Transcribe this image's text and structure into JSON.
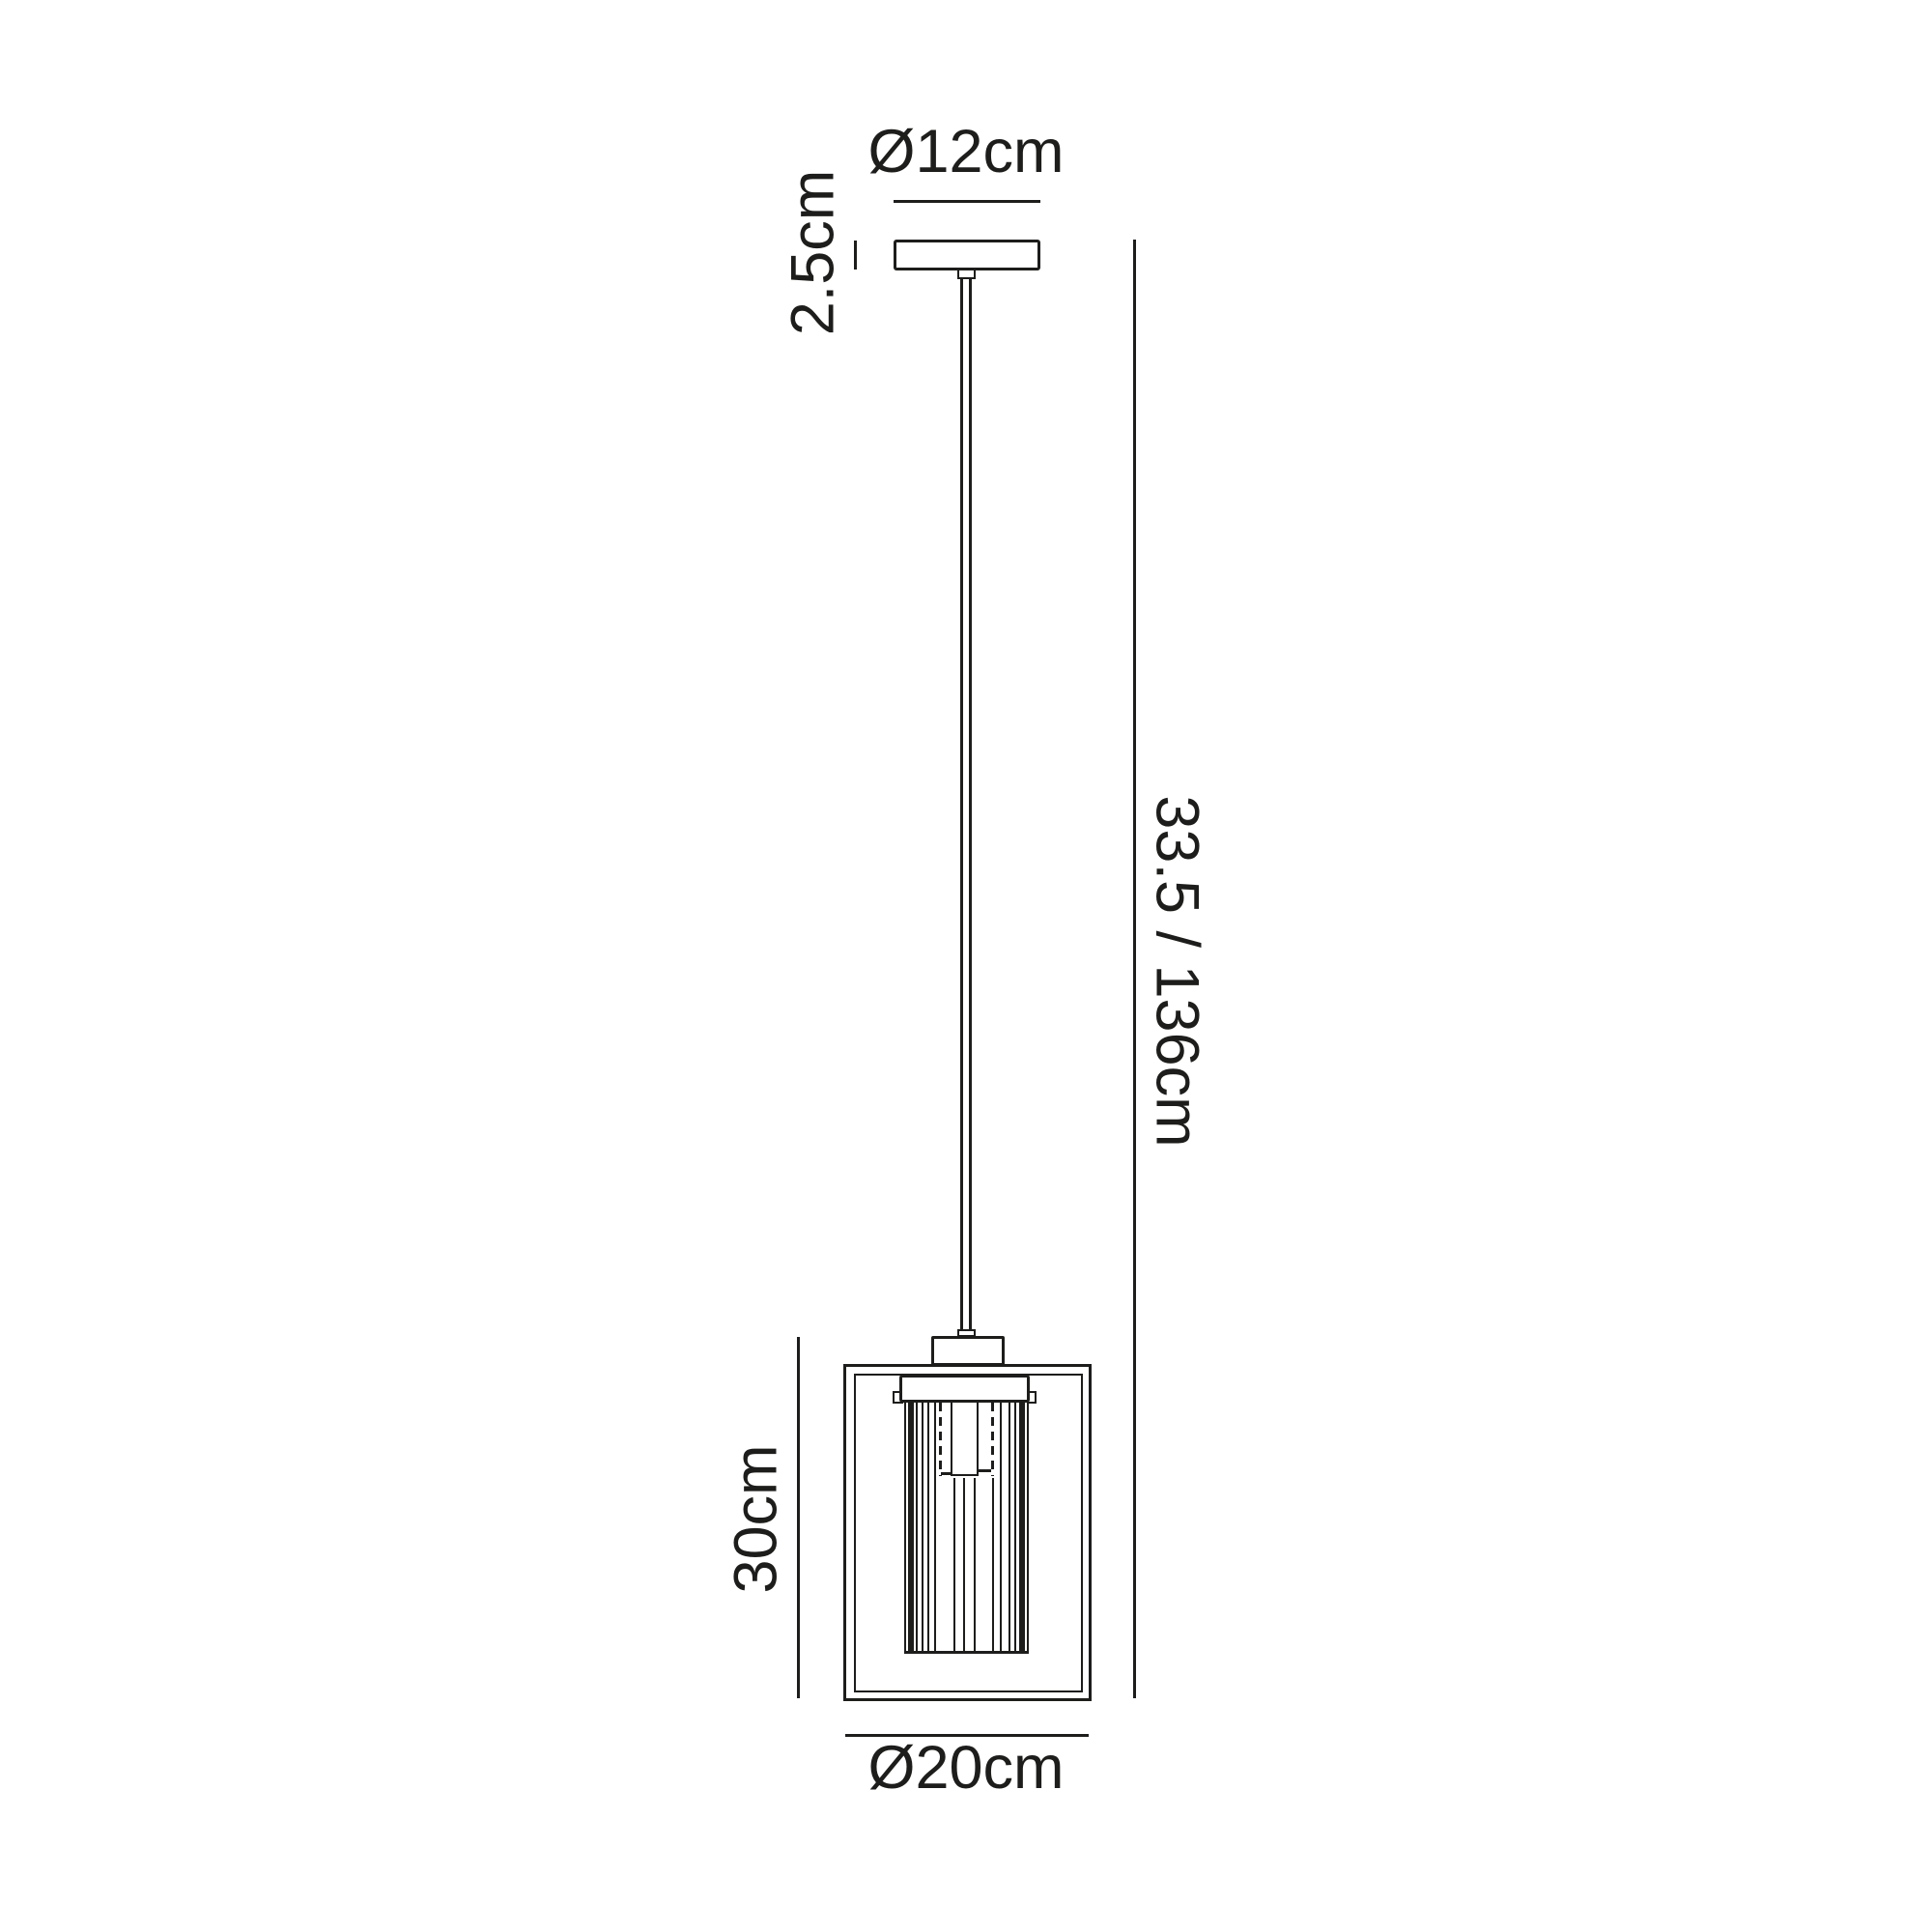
{
  "diagram": {
    "type": "pendant-light-dimension-drawing",
    "labels": {
      "canopy_diameter": "Ø12cm",
      "canopy_height": "2.5cm",
      "overall_drop": "33.5 / 136cm",
      "lantern_height": "30cm",
      "lantern_diameter": "Ø20cm"
    },
    "colors": {
      "line": "#1d1d1b",
      "background": "#ffffff"
    }
  }
}
